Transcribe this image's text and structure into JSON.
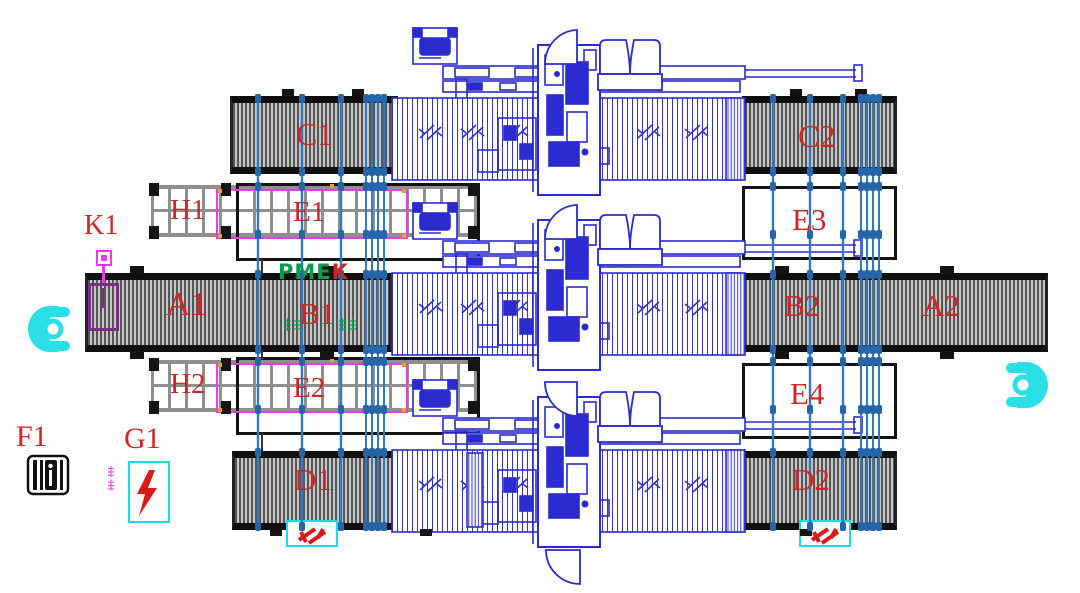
{
  "diagram": {
    "type": "factory-equipment-floor-plan",
    "logo": {
      "green_part": "PME",
      "red_part": "K"
    },
    "station_labels": {
      "c1": "C1",
      "c2": "C2",
      "d1": "D1",
      "d2": "D2",
      "a1": "A1",
      "a2": "A2",
      "b1": "B1",
      "b2": "B2",
      "e1": "E1",
      "e2": "E2",
      "e3": "E3",
      "e4": "E4",
      "h1": "H1",
      "h2": "H2",
      "k1": "K1",
      "f1": "F1",
      "g1": "G1"
    },
    "colors": {
      "label_red": "#d02626",
      "machine_blue": "#2b2bd0",
      "cable_blue": "#2e7bbf",
      "conveyor_gray": "#565656",
      "magenta": "#e93de9",
      "purple": "#7b2d8b",
      "cyan": "#1adde6",
      "logo_green": "#0f9a4e",
      "orange_marker": "#f0a020"
    },
    "icons": [
      "operator-icon-left",
      "operator-icon-right",
      "key-switch-icon",
      "electrical-cabinet-icon",
      "power-lightning-icon",
      "maintenance-lightning-icon-d1",
      "maintenance-lightning-icon-d2"
    ]
  }
}
